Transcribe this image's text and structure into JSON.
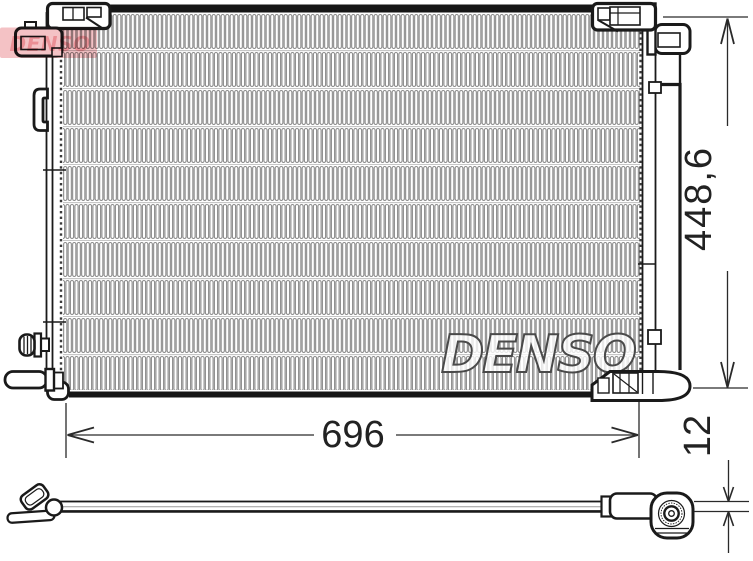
{
  "diagram": {
    "watermark_brand": "DENSO",
    "red_watermark_brand": "DENSO",
    "dimensions": {
      "width": "696",
      "height": "448,6",
      "pipe_thickness": "12"
    },
    "colors": {
      "line": "#1a1a1a",
      "fin_gray": "#8c8c8c",
      "watermark_outline": "#4a4a4a",
      "red_watermark_band": "#f4c2c5",
      "red_watermark_text": "#ea8f95"
    }
  }
}
